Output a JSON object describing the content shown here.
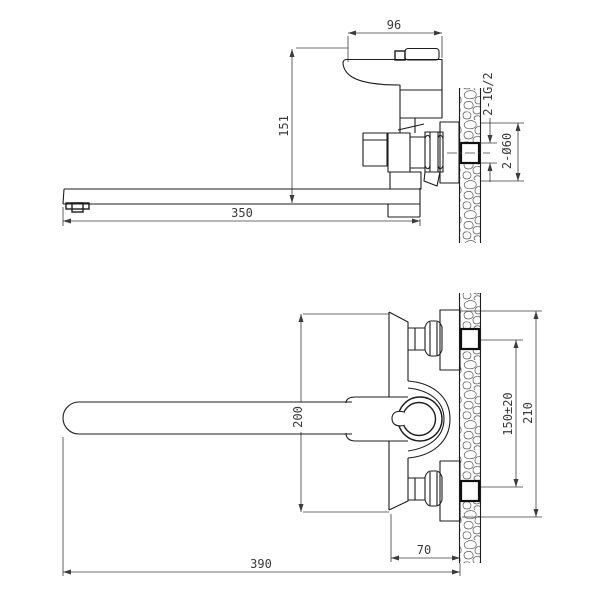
{
  "drawing": {
    "background": "#ffffff",
    "line_color": "#1c1c1c",
    "dim_color": "#3a3a3a",
    "views": {
      "side": {
        "label": "side-elevation-view",
        "dims": {
          "handle_width": "96",
          "spout_to_handle_height": "151",
          "spout_length": "350",
          "thread": "2-1G/2",
          "flange_dia": "2-Ø60"
        }
      },
      "plan": {
        "label": "plan-view",
        "dims": {
          "body_length": "200",
          "inlet_spacing": "150±20",
          "overall_body": "210",
          "wall_offset": "70",
          "overall_length": "390"
        }
      }
    }
  }
}
